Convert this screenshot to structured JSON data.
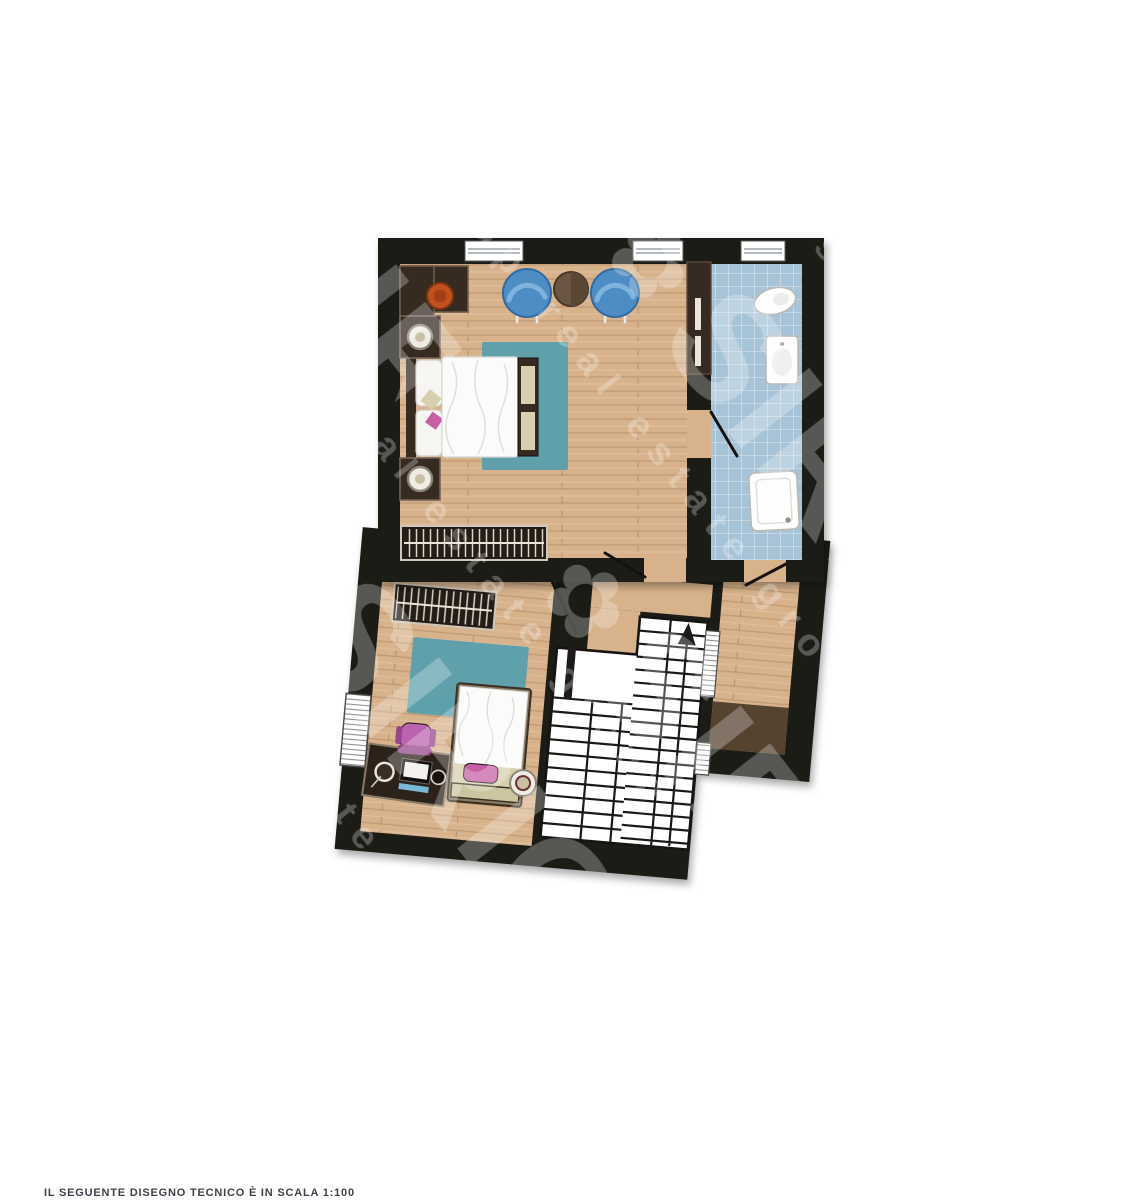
{
  "watermark": {
    "flower_glyph": "✿",
    "brand": "SIRIO",
    "tagline": "real estate group"
  },
  "caption": {
    "scale_note": "IL SEGUENTE DISEGNO TECNICO È IN SCALA 1:100"
  },
  "colors": {
    "page_bg": "#ffffff",
    "wall": "#1d1a19",
    "wood_floor": "#d8b28b",
    "tile_floor": "#a7c3d7",
    "rug_teal": "#5fa0ab",
    "armchair_blue": "#4d8dc3",
    "armchair_blue_dark": "#2f6ba2",
    "table_brown": "#6b5645",
    "chair_orange": "#c0511d",
    "chair_pink": "#bb63ae",
    "furniture_brown": "#362a21",
    "mat_brown": "#55422f",
    "stairs_white": "#ffffff",
    "linen_white": "#fbfbfa",
    "cushion_beige": "#d7cfae",
    "pillow_pink": "#c75fa5",
    "caption_text": "#3d424a"
  }
}
